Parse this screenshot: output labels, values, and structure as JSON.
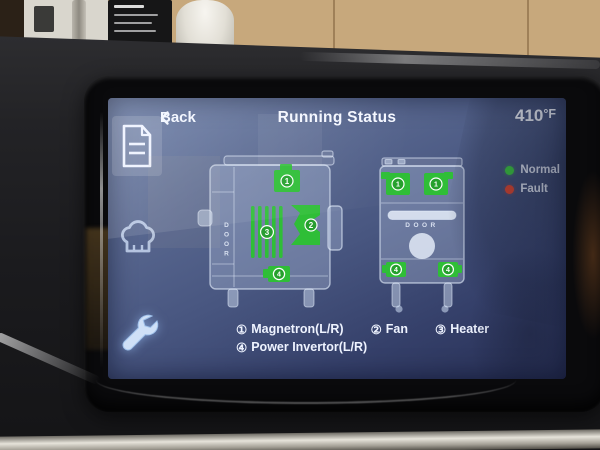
{
  "top_bar": {
    "back_label": "Back",
    "title": "Running Status",
    "temperature_value": "410",
    "temperature_unit": "°F"
  },
  "sidebar": {
    "items": [
      {
        "id": "status-log",
        "icon": "document-icon",
        "active": true
      },
      {
        "id": "recipes",
        "icon": "chef-hat-icon",
        "active": false
      },
      {
        "id": "service",
        "icon": "wrench-icon",
        "active": false
      }
    ]
  },
  "legend": {
    "items": [
      {
        "label": "Normal",
        "color": "#3fd23f"
      },
      {
        "label": "Fault",
        "color": "#e8482e"
      }
    ]
  },
  "diagram": {
    "door_label": "DOOR",
    "component_color": "#2fbe37",
    "side_view": {
      "magnetron": {
        "num": "1",
        "status": "normal"
      },
      "fan": {
        "num": "2",
        "status": "normal"
      },
      "heater": {
        "num": "3",
        "status": "normal"
      },
      "power_invertor": {
        "num": "4",
        "status": "normal"
      }
    },
    "front_view": {
      "magnetron_left": {
        "num": "1",
        "status": "normal"
      },
      "magnetron_right": {
        "num": "1",
        "status": "normal"
      },
      "power_invertor_left": {
        "num": "4",
        "status": "normal"
      },
      "power_invertor_right": {
        "num": "4",
        "status": "normal"
      }
    }
  },
  "footnotes": {
    "line1": [
      {
        "num": "①",
        "label": "Magnetron(L/R)"
      },
      {
        "num": "②",
        "label": "Fan"
      },
      {
        "num": "③",
        "label": "Heater"
      }
    ],
    "line2": [
      {
        "num": "④",
        "label": "Power Invertor(L/R)"
      }
    ]
  },
  "colors": {
    "screen_top": "#7082aa",
    "screen_bottom": "#272f54",
    "component_green": "#2fbe37",
    "normal": "#3fd23f",
    "fault": "#e8482e",
    "text": "#f4f7ff"
  }
}
